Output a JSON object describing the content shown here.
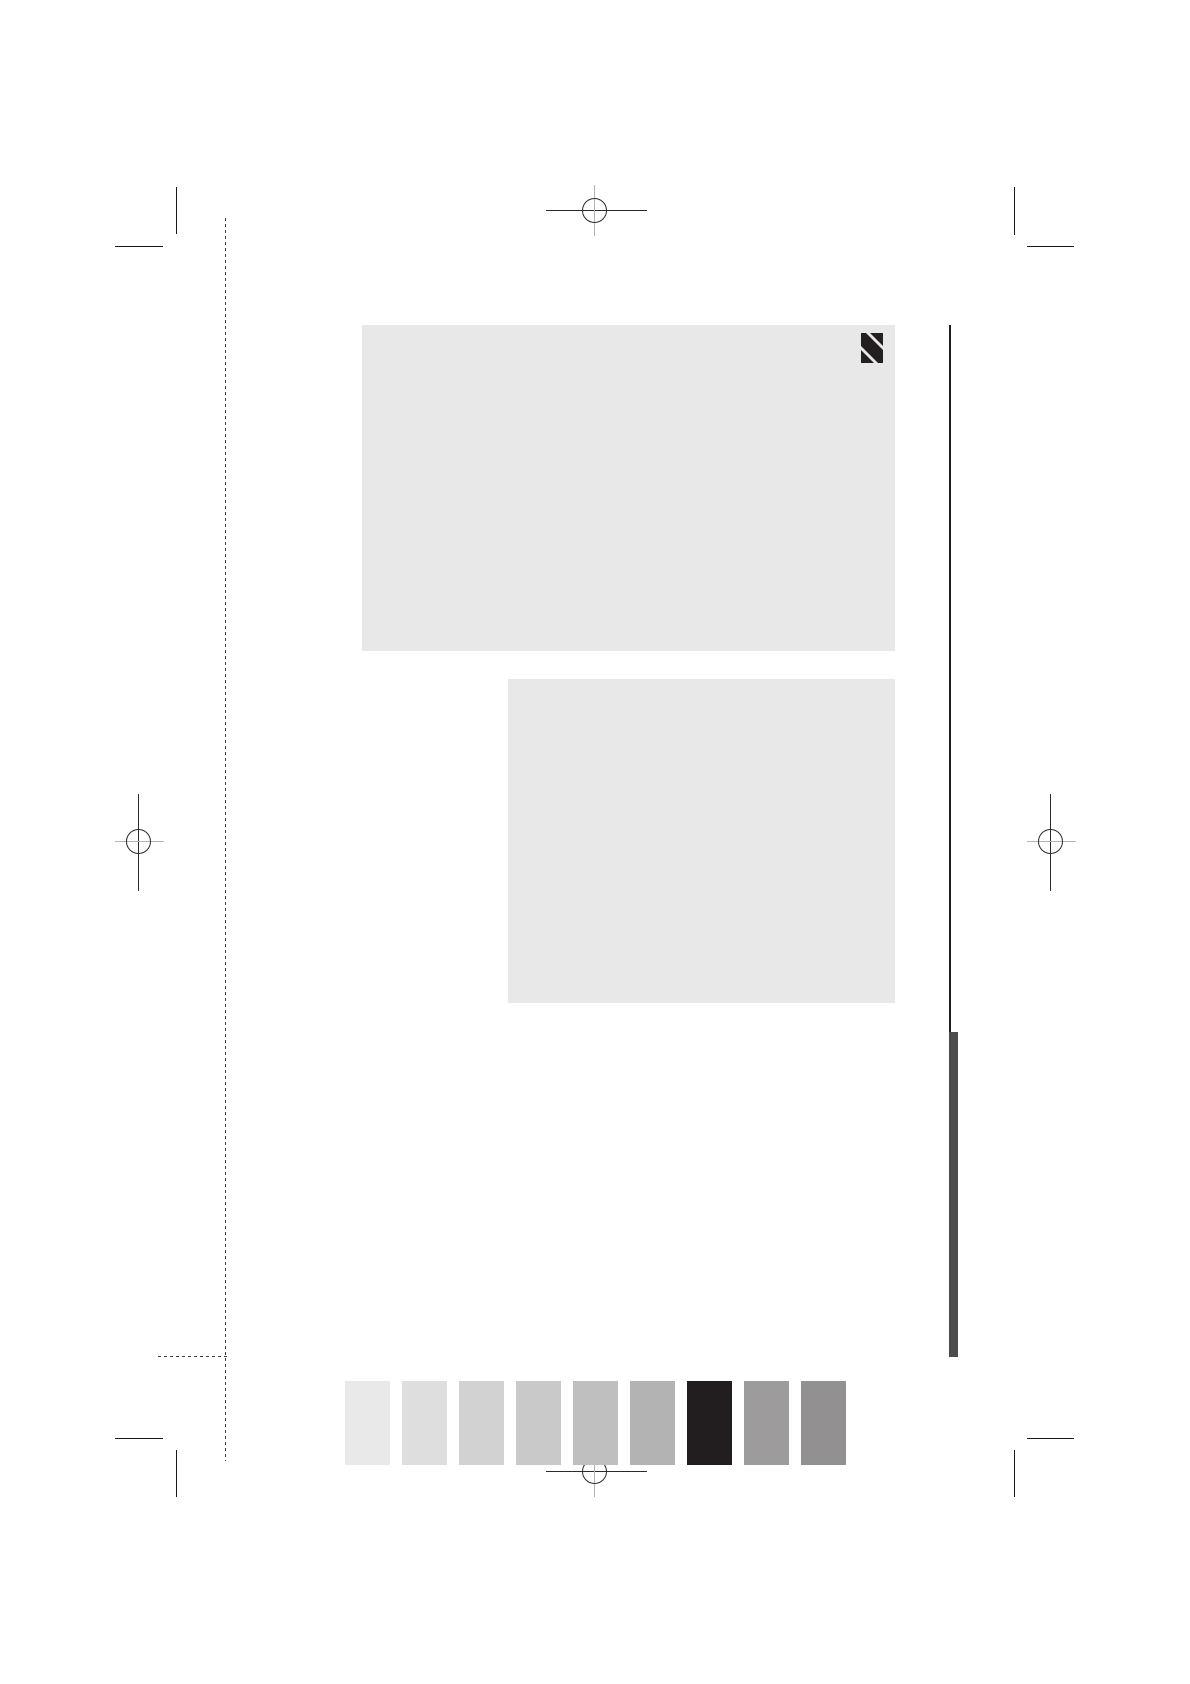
{
  "document": {
    "type": "print-proof-page",
    "background": "#ffffff"
  },
  "content_blocks": {
    "block_1": {
      "color": "#e8e8e8"
    },
    "block_2": {
      "color": "#e8e8e8"
    }
  },
  "logo": {
    "name": "diagonal-stripes-logo",
    "color": "#231f20"
  },
  "printer_marks": {
    "crop_mark_color": "#1a1a1a",
    "registration_stroke_dark": "#2b2b2b",
    "registration_stroke_light": "#b3b3b3",
    "fold_dash_color": "#3a3a3a"
  },
  "rules": {
    "thin_rule_color": "#1f1f1f",
    "thick_bar_color": "#4d4b4c"
  },
  "calibration_bar": {
    "swatch_colors": [
      "#e9e9e9",
      "#dedede",
      "#d2d2d2",
      "#c9c9c9",
      "#bfbfbf",
      "#b3b3b3",
      "#221e20",
      "#9d9b9c",
      "#929091"
    ]
  }
}
